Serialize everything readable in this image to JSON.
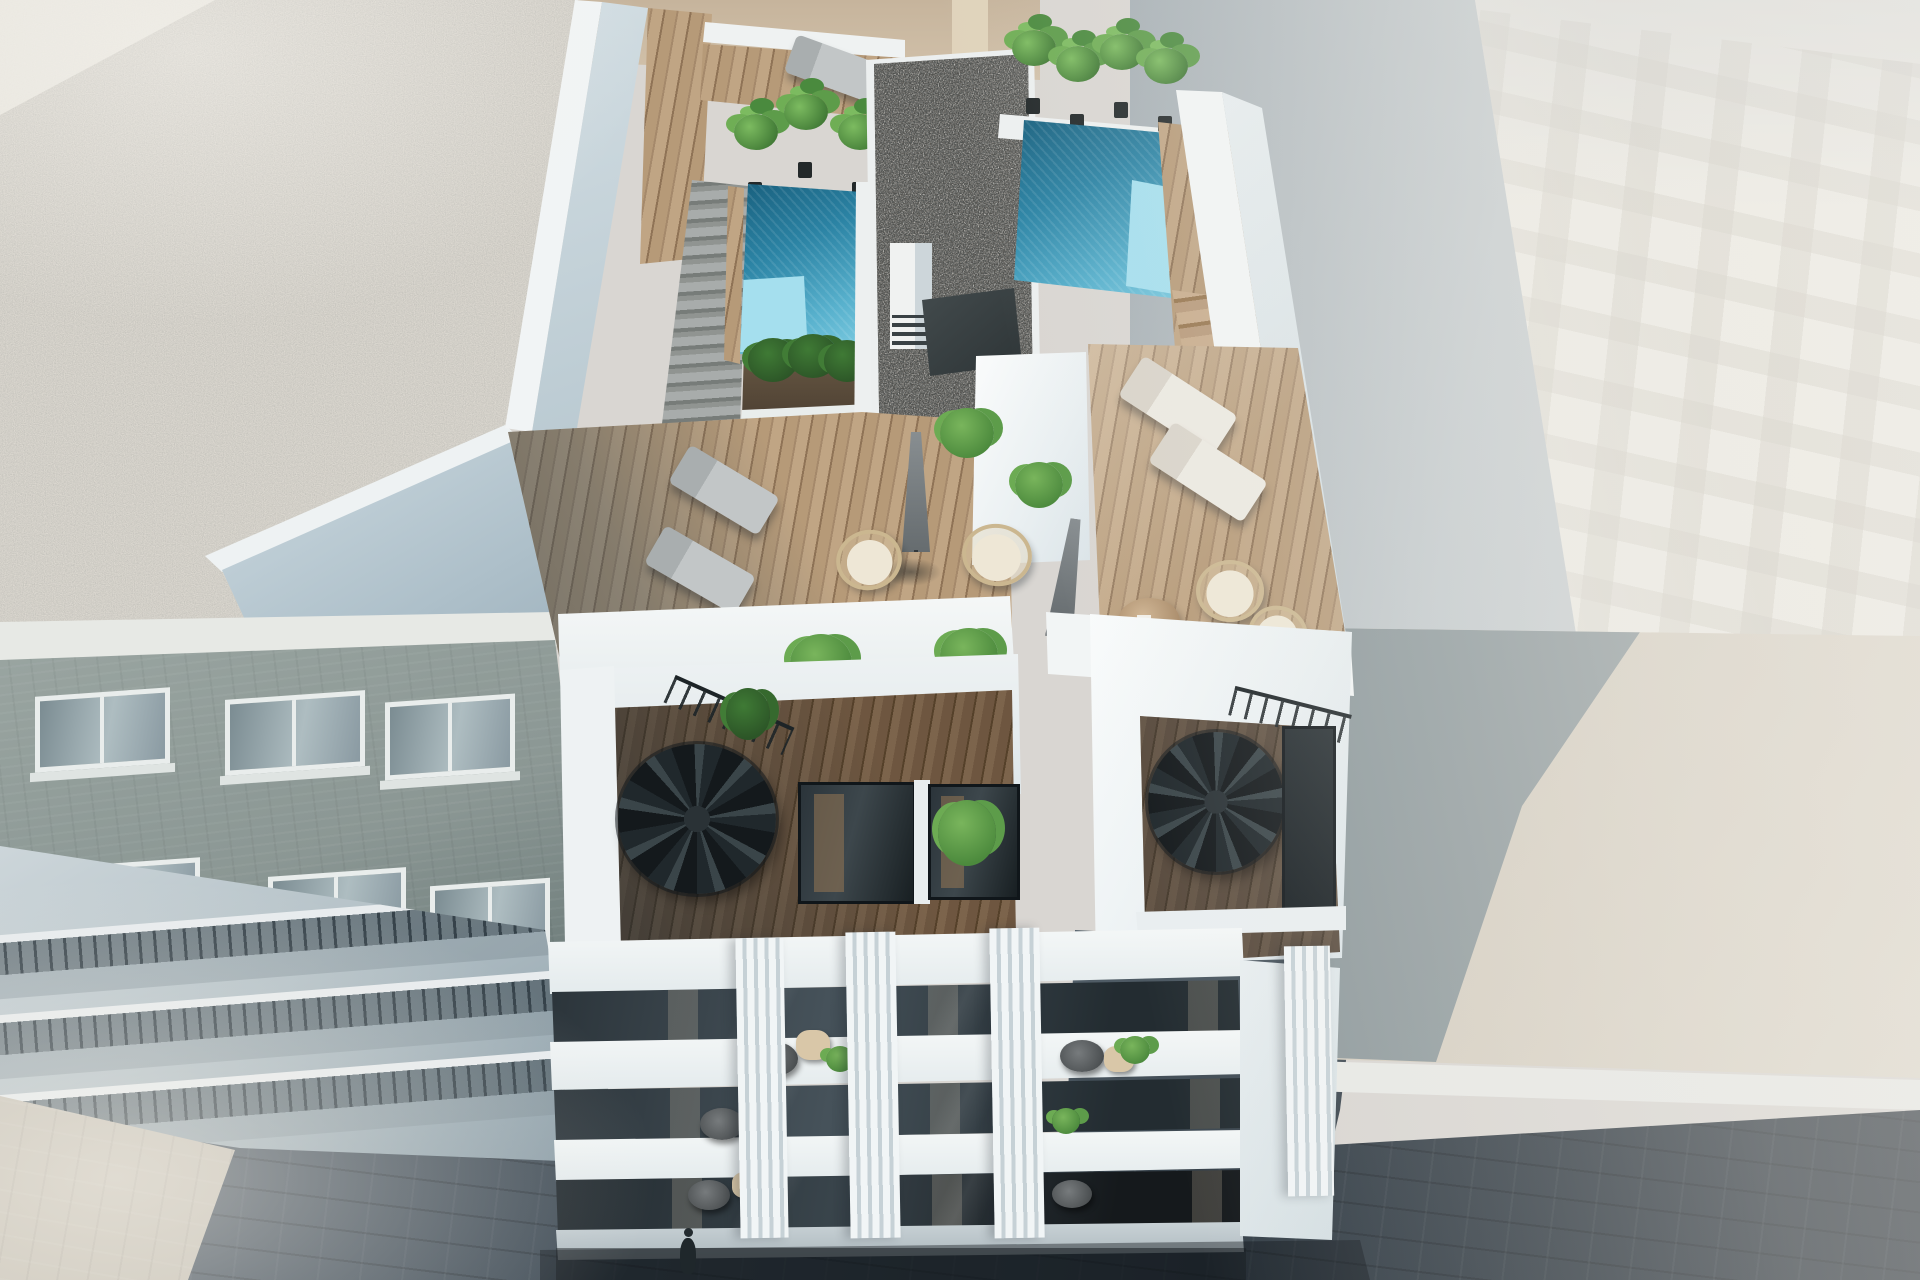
{
  "scene": {
    "title": "Aerial 3D architectural render of a modern apartment building",
    "description": "Bird's-eye photorealistic rendering of a white residential building whose rooftop has two turquoise swimming pools, a dark gravel roof core with chimney, wooden deck terraces with sun loungers, round rattan chairs, closed parasols and tropical potted plants; a setback penthouse level with two black spiral staircases and glass doors; a tiered street facade with glass balconies, round tables and white vertical fins; flanked by a neighbouring gravel-roofed brick building with balconies on the left, a pale high-rise with a window grid on the right, a sunlit low roof crossed by a large shadow, and cobbled streets with a single pedestrian below",
    "time_of_day": "daylight",
    "style": "photorealistic CGI exterior visualisation"
  },
  "objects": {
    "swimming_pools": 2,
    "sun_loungers_gray": 3,
    "sun_loungers_white": 2,
    "spiral_staircases": 2,
    "closed_parasols": 2,
    "round_rattan_chairs": 4,
    "round_wooden_tables": 2,
    "balcony_tables": 5,
    "potted_plants_and_bushes": 20,
    "stair_flights": 3,
    "pedestrians": 1
  },
  "palette": {
    "sky-1": "#a7b0b5",
    "sky-2": "#d6d9da",
    "right-bldg": "#edebe4",
    "beige-wall": "#c6b49c",
    "beige-strip": "#e0d3bb",
    "speckle-base": "#ddd9d1",
    "brick-1": "#9aa5a1",
    "brick-2": "#5f6d6c",
    "balc-1": "#ced7db",
    "balc-2": "#8a9ba5",
    "pave": "#c8c3b7",
    "street-1": "#535f6a",
    "street-2": "#272f37",
    "white-hi": "#f6f8f8",
    "pool-deep": "#19607e",
    "pool-mid": "#58b1cd",
    "pool-light": "#86d2e6",
    "pool-shelf": "#a5dfee",
    "gravel": "#53504b",
    "wood-1": "#b69a78",
    "wood-2": "#8f7356",
    "wood-dark-1": "#7a6047",
    "wood-dark-2": "#5f482f",
    "wood-step": "#c8ac8c",
    "plant-1": "#6fae55",
    "plant-2": "#47813a",
    "plant-dark": "#2c5527",
    "lounger-gray": "#c2c6c7",
    "lounger-white": "#ece9e1",
    "rattan": "#cbb790",
    "cushion": "#eee7d6",
    "umbrella": "#888e91",
    "stair-metal": "#20282c",
    "glass-1": "#2b343a",
    "glass-2": "#46525a",
    "roof-shadow": "rgba(122,138,146,0.78)",
    "table-wood": "#a98a67"
  }
}
